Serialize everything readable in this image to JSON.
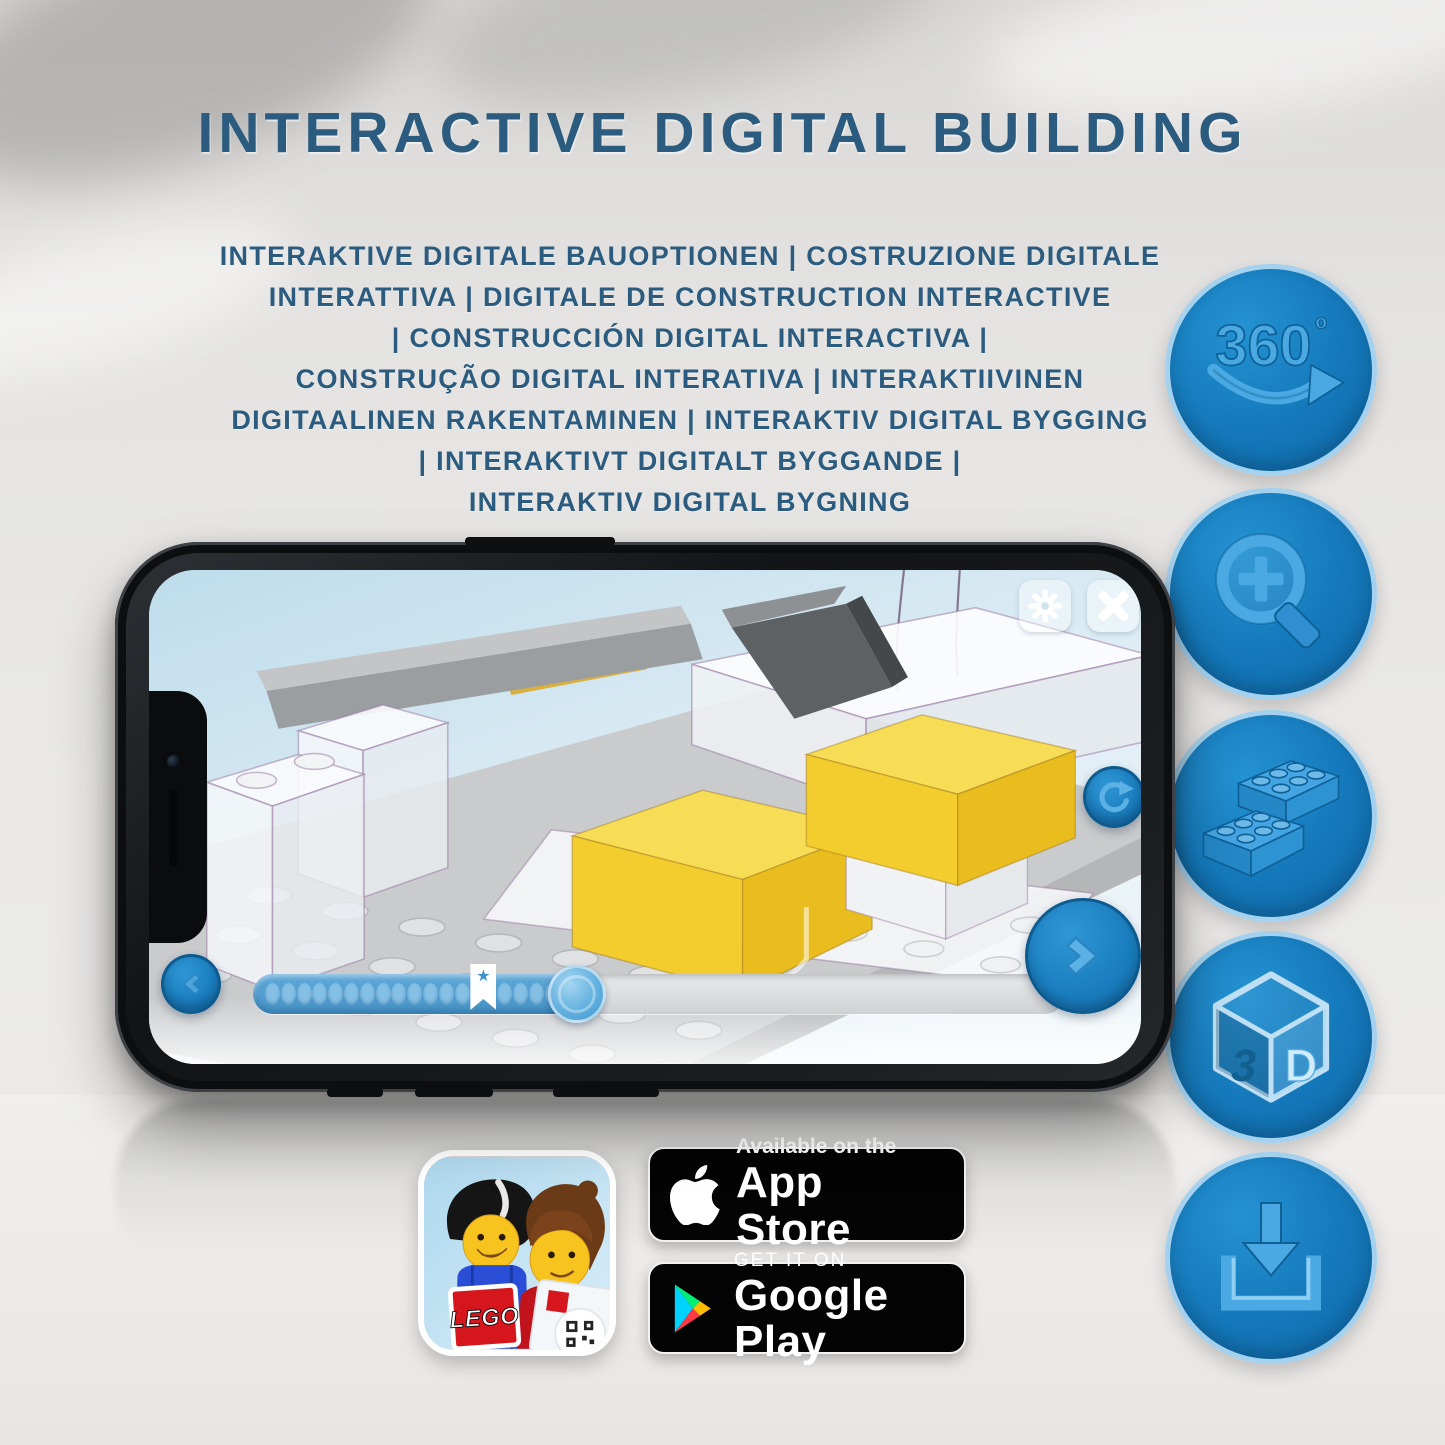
{
  "header": {
    "title": "INTERACTIVE DIGITAL BUILDING",
    "subtitle_lines": [
      "INTERAKTIVE DIGITALE BAUOPTIONEN | COSTRUZIONE DIGITALE",
      "INTERATTIVA | DIGITALE DE CONSTRUCTION INTERACTIVE",
      "| CONSTRUCCIÓN DIGITAL INTERACTIVA |",
      "CONSTRUÇÃO DIGITAL INTERATIVA | INTERAKTIIVINEN",
      "DIGITAALINEN RAKENTAMINEN | INTERAKTIV DIGITAL BYGGING",
      "| INTERAKTIVT DIGITALT BYGGANDE |",
      "INTERAKTIV DIGITAL BYGNING"
    ]
  },
  "feature_icons": {
    "rotation_360": {
      "label": "360",
      "degree": "º",
      "name": "360-rotation-icon"
    },
    "zoom": {
      "name": "zoom-in-magnifier-icon"
    },
    "bricks": {
      "name": "building-bricks-icon"
    },
    "three_d": {
      "left": "3",
      "right": "D",
      "name": "3d-view-icon"
    },
    "download": {
      "name": "download-icon"
    }
  },
  "phone_app": {
    "slider": {
      "progress_percent": 40,
      "dots_before_bookmark": 13,
      "dots_after_bookmark": 4,
      "bookmark_star": "★"
    }
  },
  "store_badges": {
    "app_store": {
      "line1": "Available on the",
      "line2": "App Store"
    },
    "google_play": {
      "line1": "GET IT ON",
      "line2": "Google Play"
    }
  },
  "app_icon": {
    "logo": "LEGO"
  },
  "colors": {
    "title_blue": "#2b5b7e",
    "icon_circle_blue": "#1279bd",
    "icon_glyph_blue": "#4aa8e2",
    "lego_yellow": "#f2cf3a",
    "ui_button_blue": "#1a80c2"
  }
}
